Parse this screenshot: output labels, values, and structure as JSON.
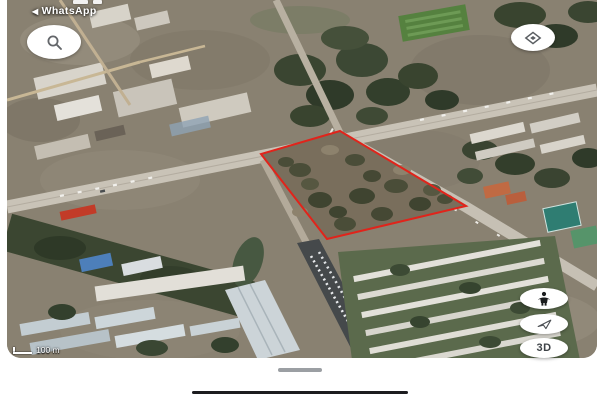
{
  "app": "google-earth-mobile-satellite-view",
  "status_bar": {
    "back_arrow": "◀",
    "breadcrumb": "WhatsApp",
    "clipped_glyphs_icon": "partial-statusbar-text"
  },
  "map": {
    "view": "tilted satellite imagery of a road intersection with vacant lot outlined",
    "parcel": {
      "outline_color": "#e0241b",
      "shape": "quadrilateral",
      "vertices": [
        [
          340,
          131
        ],
        [
          466,
          206
        ],
        [
          327,
          239
        ],
        [
          261,
          154
        ]
      ]
    },
    "scale": {
      "label": "100 m"
    }
  },
  "controls": {
    "search": {
      "icon": "magnifier-icon"
    },
    "map_style": {
      "icon": "layers-diamond-icon"
    },
    "street_view": {
      "icon": "pegman-icon"
    },
    "orientation": {
      "icon": "navigation-arrow-icon"
    },
    "three_d": {
      "label": "3D"
    }
  },
  "system": {
    "sheet_handle_icon": "drag-handle",
    "home_indicator_icon": "home-indicator-bar"
  },
  "colors": {
    "parcel_red": "#e0241b",
    "button_bg": "#ffffff",
    "icon_gray": "#5a5e62",
    "scale_text": "#ffffff",
    "road_light": "#c9c3b7",
    "tree_dark": "#3a4531",
    "land_base": "#898171"
  }
}
